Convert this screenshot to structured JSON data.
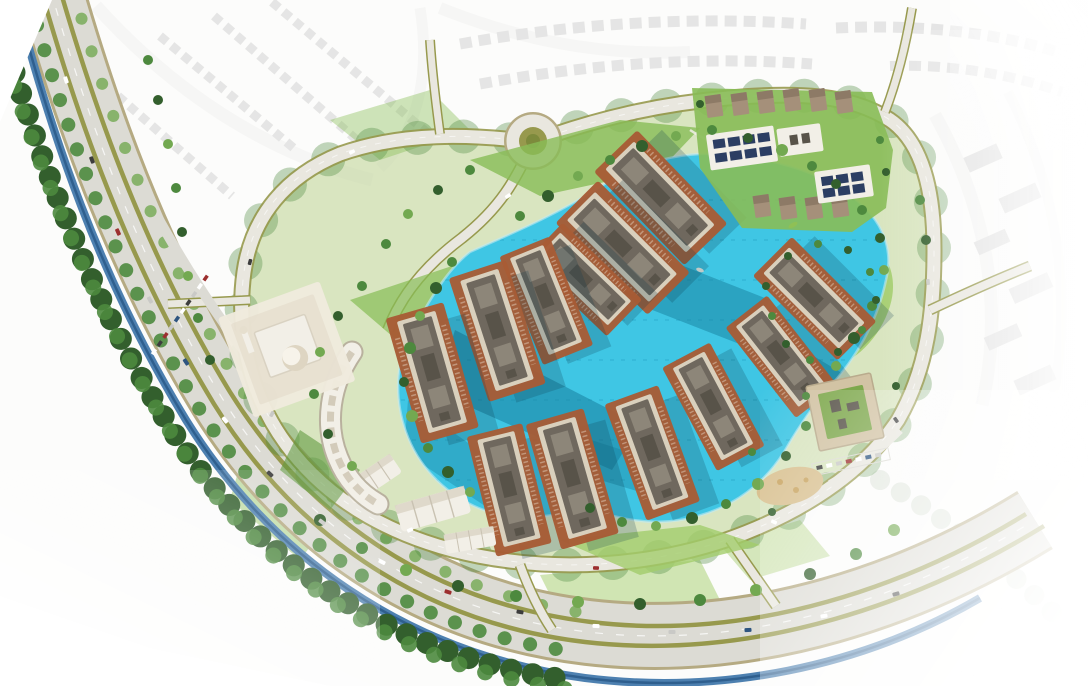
{
  "meta": {
    "title": "Aerial masterplan rendering of a waterfront residential lagoon community"
  },
  "palette": {
    "pageBg": "#fcfcfb",
    "white": "#ffffff",
    "lake": "#3fc6e4",
    "lakeShadow": "#17809e",
    "lakeLine": "#1f9cbd",
    "grass": "#88bd56",
    "grassLight": "#a3cd6c",
    "grassDark": "#60993f",
    "siteBase": "#bcd18f",
    "tree": "#4d893e",
    "treeDark": "#335f2d",
    "treeLight": "#73a951",
    "olive": "#97994d",
    "road": "#dcdbd4",
    "roadLight": "#e9e7df",
    "roadEdge": "#b5aa82",
    "canal": "#4d80b0",
    "canalDark": "#2f5f8e",
    "terracotta": "#a85c35",
    "terracottaDark": "#8f4a2a",
    "roof": "#6f685e",
    "roofDark": "#585349",
    "roofLight": "#8d8679",
    "wall": "#d9d0bd",
    "whiteBldg": "#f2efe7",
    "plaza": "#f0eadd",
    "dome": "#ded5c2",
    "sand": "#d9c191",
    "solar": "#2c3e63",
    "greenRoof": "#7ea84d",
    "contextGray": "#c7c7c5",
    "contextRoad": "#efefed",
    "contextTree": "#aebfa8"
  },
  "features": {
    "lagoon": "central swimmable lagoon",
    "boulevard": "arterial boulevard with landscaped medians",
    "canal": "tree-lined canal along boulevard",
    "loop_road": "internal loop road",
    "roundabout": "entry roundabout",
    "towers": "waterfront residential towers on terracotta podium decks",
    "crescent": "crescent terraced low-rise building",
    "mosque": "domed mosque on plaza",
    "townhouses": "townhouse cluster with rooftop solar panels",
    "clubhouse": "clubhouse with green roof",
    "playground": "sand playground",
    "park": "lakeside park lawns",
    "context": "surrounding neighborhood shown faded white",
    "kayak": "kayak on the lagoon"
  }
}
